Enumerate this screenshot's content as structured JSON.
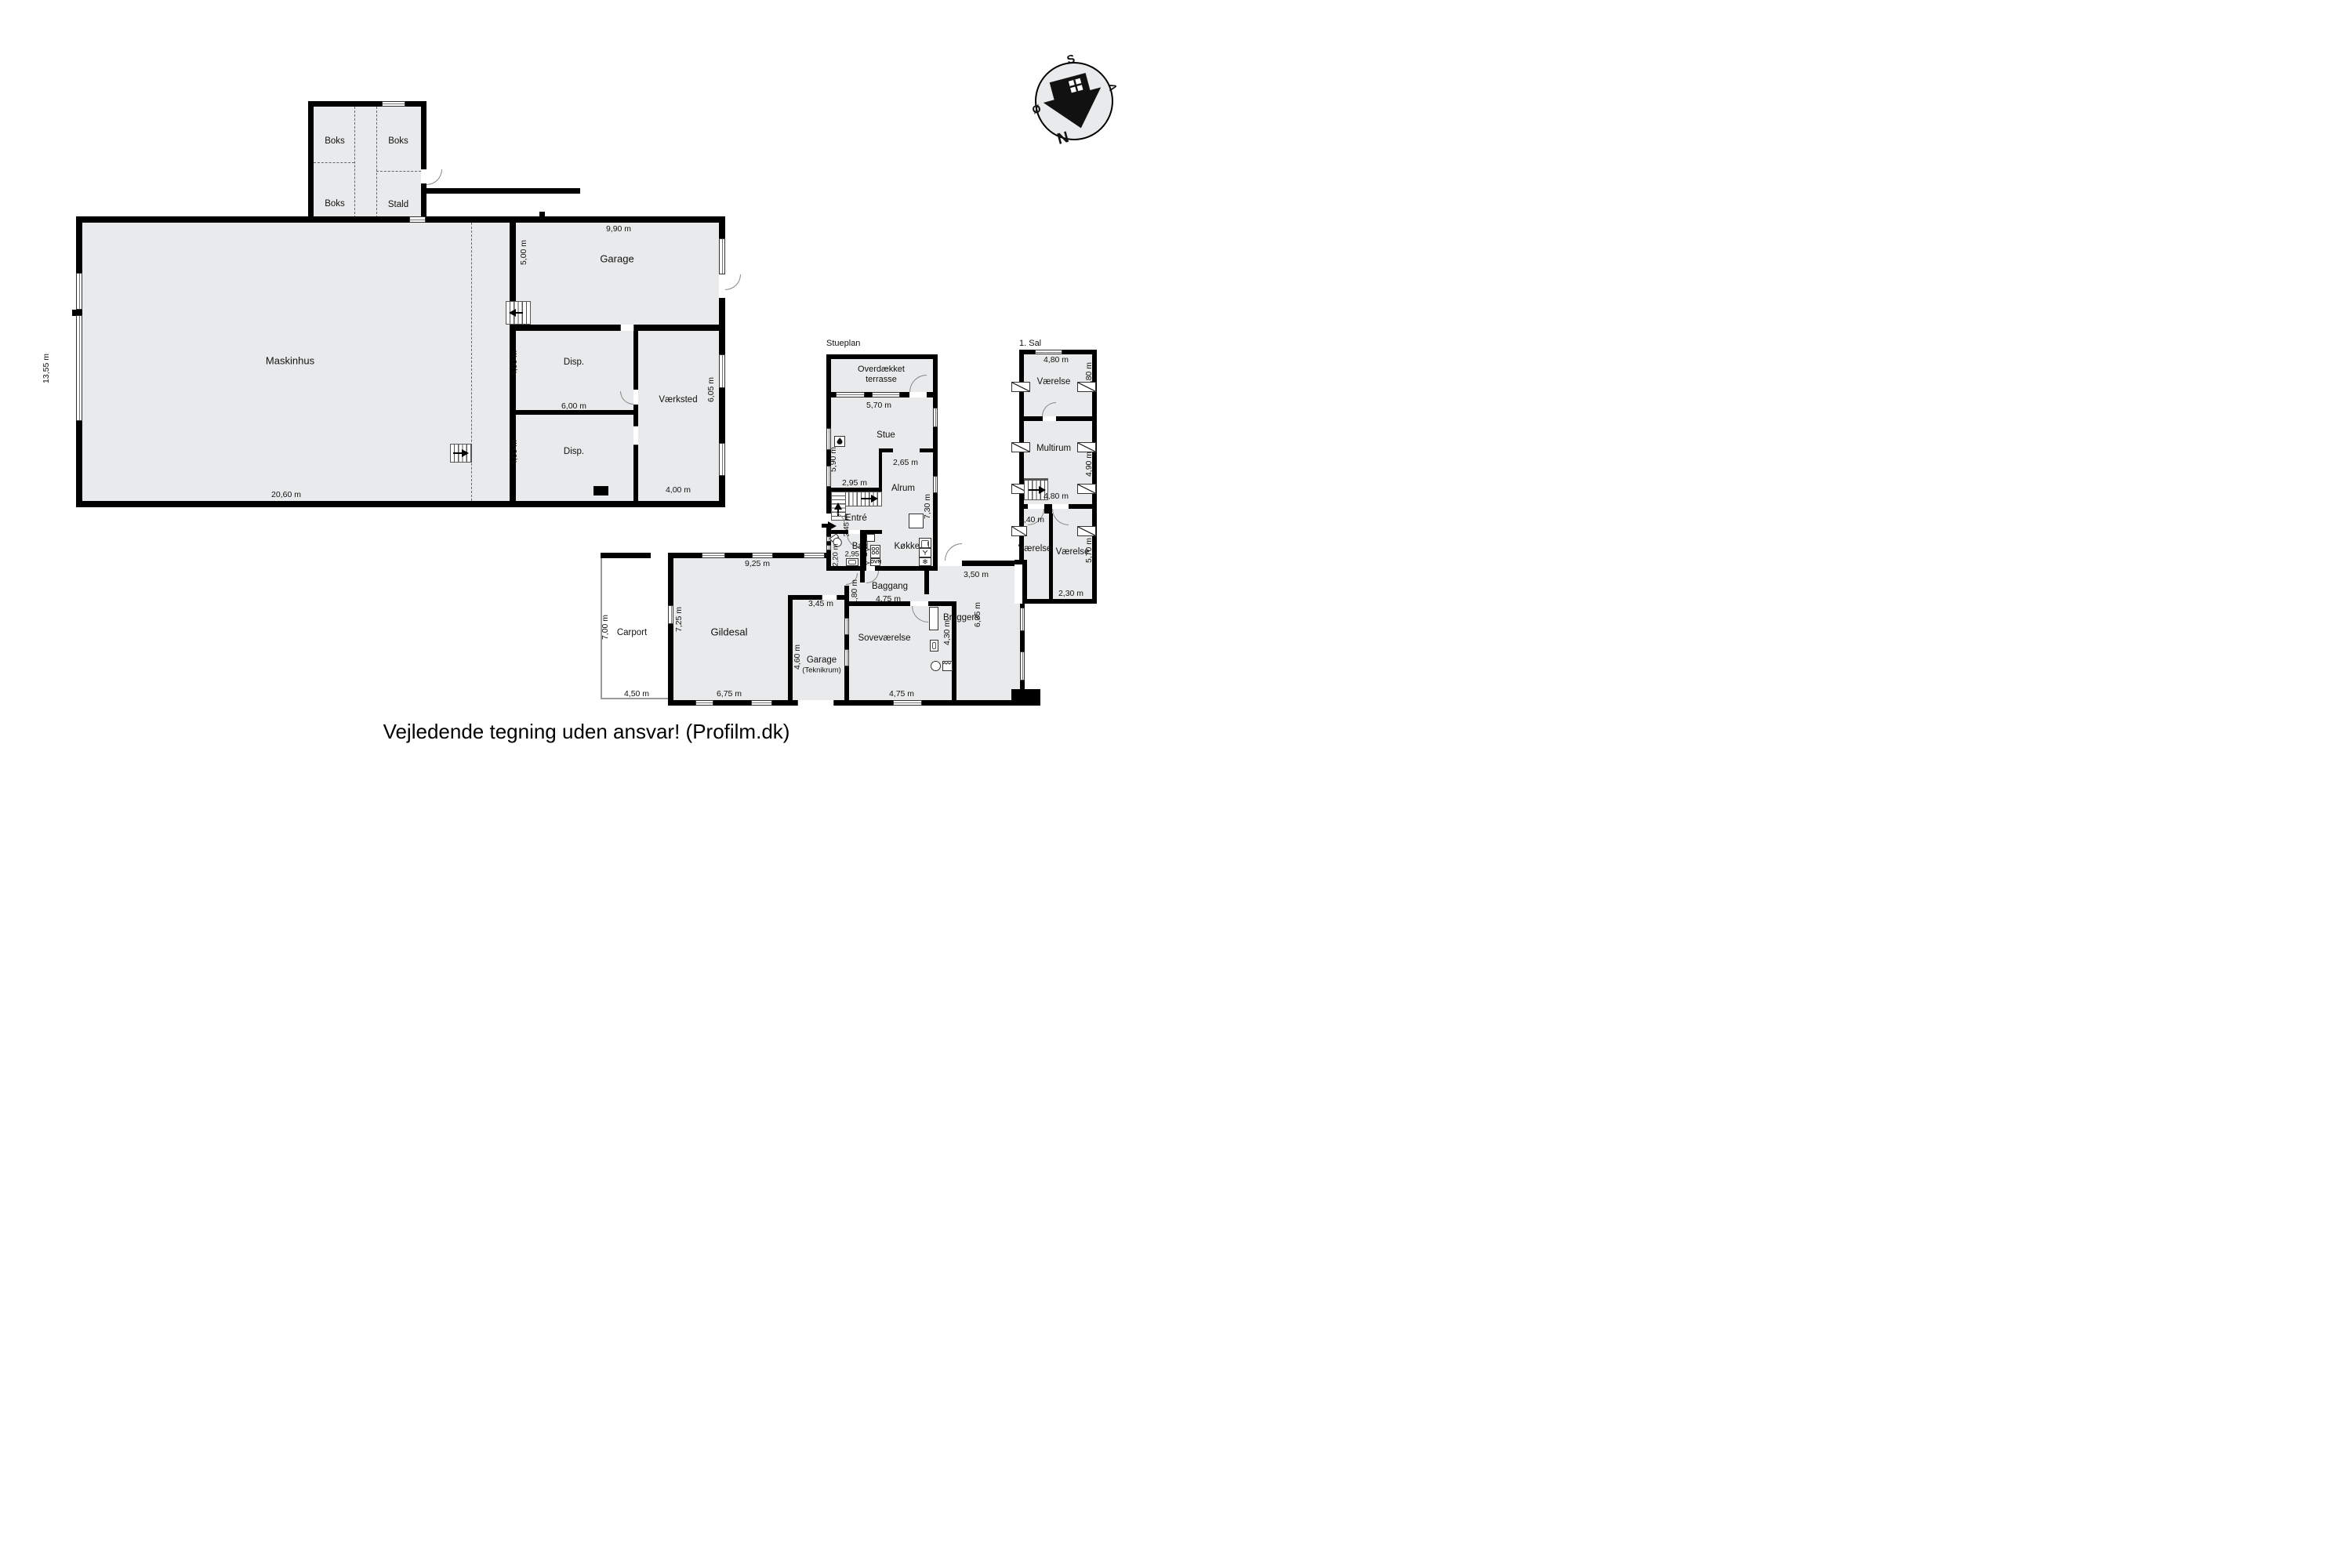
{
  "footer": "Vejledende tegning uden ansvar! (Profilm.dk)",
  "colors": {
    "wall": "#000000",
    "floor_fill": "#e9eaeb",
    "outside": "#ffffff"
  },
  "compass": {
    "s": "S",
    "v": "V",
    "n": "N",
    "oe": "Ø"
  },
  "icons": {
    "snowflake": "❄",
    "vent": "≻"
  },
  "barn": {
    "boks_tl": "Boks",
    "boks_tr": "Boks",
    "boks_bl": "Boks",
    "stald": "Stald"
  },
  "machine_house": {
    "name": "Maskinhus",
    "height": "13,55 m",
    "width": "20,60 m",
    "garage": {
      "name": "Garage",
      "width": "9,90 m",
      "height": "5,00 m"
    },
    "disp1": {
      "name": "Disp.",
      "height": "4,00 m",
      "width": "6,00 m"
    },
    "disp2": {
      "name": "Disp.",
      "height": "4,00 m"
    },
    "vaerksted": {
      "name": "Værksted",
      "height": "6,05 m",
      "width": "4,00 m"
    }
  },
  "ground_floor": {
    "plan_label": "Stueplan",
    "terrace": {
      "name": "Overdækket terrasse",
      "width": "5,70 m"
    },
    "stue": {
      "name": "Stue",
      "height": "5,90 m"
    },
    "alrum": {
      "name": "Alrum",
      "opening": "2,65 m",
      "height": "7,30 m"
    },
    "stairs_width": "2,95 m",
    "entre": {
      "name": "Entré",
      "height": "2,45 m"
    },
    "bad": {
      "name": "Bad",
      "height": "2,20 m",
      "width": "2,95 m"
    },
    "koekken": {
      "name": "Køkken",
      "oven": "OVN"
    },
    "baggang": {
      "name": "Baggang",
      "height": "1,80 m",
      "width": "4,75 m",
      "right_width": "3,50 m"
    },
    "bryggers": {
      "name": "Bryggers",
      "height": "6,35 m"
    },
    "sovevaerelse": {
      "name": "Soveværelse",
      "height": "4,30 m",
      "width": "4,75 m"
    },
    "gildesal": {
      "name": "Gildesal",
      "width_top": "9,25 m",
      "height": "7,25 m",
      "width_bottom": "6,75 m"
    },
    "garage_teknik": {
      "name": "Garage",
      "name2": "(Teknikrum)",
      "width": "3,45 m",
      "height": "4,60 m"
    },
    "carport": {
      "name": "Carport",
      "height": "7,00 m",
      "width": "4,50 m"
    }
  },
  "first_floor": {
    "plan_label": "1. Sal",
    "top_width": "4,80 m",
    "vaerelse_top": {
      "name": "Værelse",
      "height": "3,80 m"
    },
    "multirum": {
      "name": "Multirum",
      "height": "4,90 m"
    },
    "landing_width": "4,80 m",
    "hall_width": "2,40 m",
    "vaerelse_bl": {
      "name": "Værelse"
    },
    "vaerelse_br": {
      "name": "Værelse",
      "height": "5,70 m",
      "width": "2,30 m"
    }
  }
}
